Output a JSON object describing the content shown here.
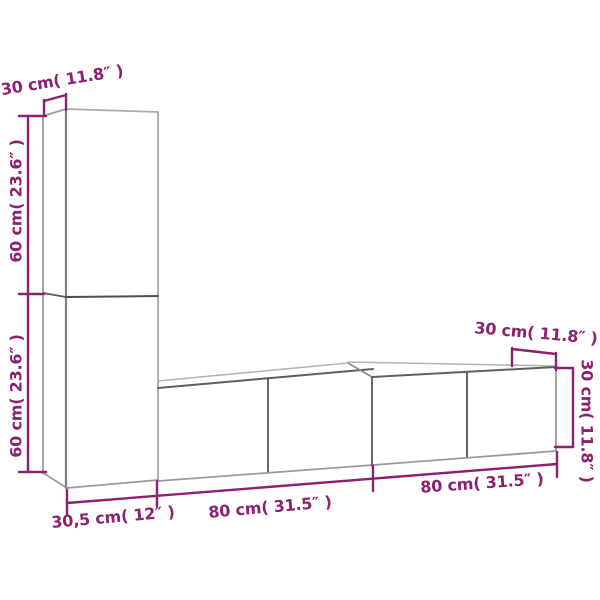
{
  "diagram": {
    "kind": "furniture-dimension-diagram",
    "units_shown": [
      "cm",
      "inches"
    ],
    "labels": {
      "tall_depth": "30 cm( 11.8″ )",
      "tall_upper_height": "60 cm( 23.6″ )",
      "tall_lower_height": "60 cm( 23.6″ )",
      "tall_width": "30,5 cm( 12″ )",
      "unit_left_width": "80 cm( 31.5″ )",
      "unit_right_width": "80 cm( 31.5″ )",
      "unit_right_depth": "30 cm( 11.8″ )",
      "unit_right_height": "30 cm( 11.8″ )"
    },
    "colors": {
      "dimension_accent": "#8C2071",
      "edge_light": "#b5b5b5",
      "edge_mid": "#999999",
      "edge_dark": "#555555",
      "background": "#ffffff"
    }
  }
}
